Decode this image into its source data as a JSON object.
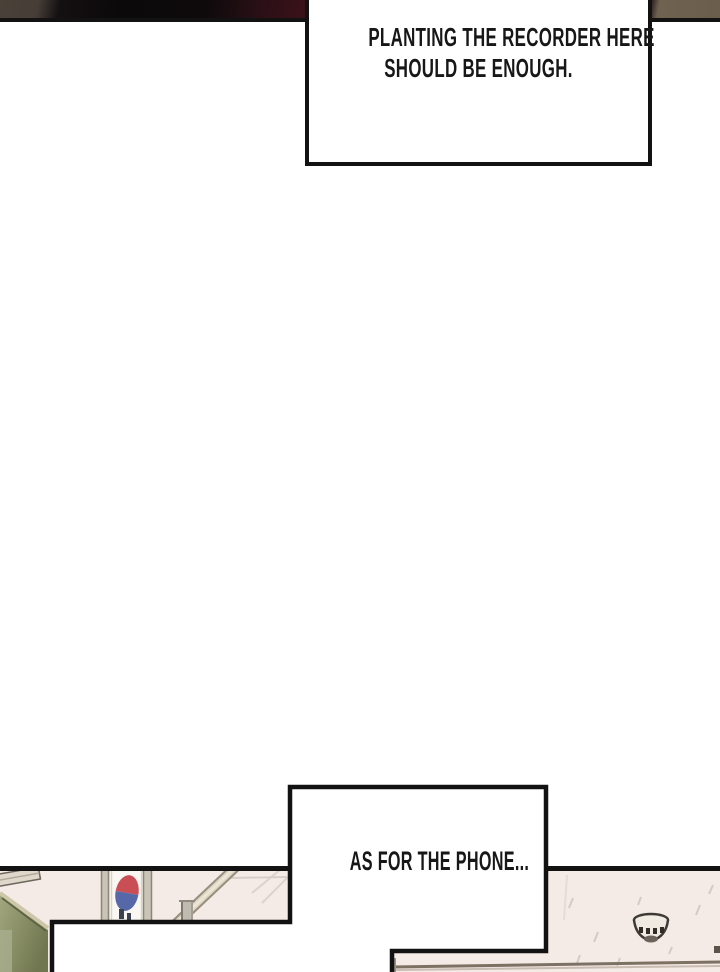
{
  "page": {
    "kind": "webtoon-comic-page",
    "width": 720,
    "height": 972,
    "background": "#ffffff"
  },
  "bubbles": {
    "recorder": {
      "line1": "PLANTING THE RECORDER HERE",
      "line2": "SHOULD BE ENOUGH."
    },
    "phone": {
      "line1": "AS FOR THE PHONE..."
    }
  },
  "colors": {
    "panel_border": "#121212",
    "bubble_border": "#121212",
    "text_ink": "#171717",
    "top_strip_brown": "#4a4139",
    "top_strip_black": "#0c0a0b",
    "top_strip_maroon": "#3a1119",
    "top_strip_tan": "#6f6250",
    "wall_pink": "#f4eae6",
    "chalkboard_green_light": "#a2a77f",
    "chalkboard_green_dark": "#70764f",
    "flag_red": "#c94f55",
    "flag_blue": "#5668a8",
    "beam_beige": "#ddd5c3",
    "rail_brown": "#7d7164"
  },
  "artwork": {
    "top_panel": "dark close-up strip",
    "bottom_panel": "classroom corner with korean flag, chalkboard, beam and ceiling sprinkler"
  }
}
